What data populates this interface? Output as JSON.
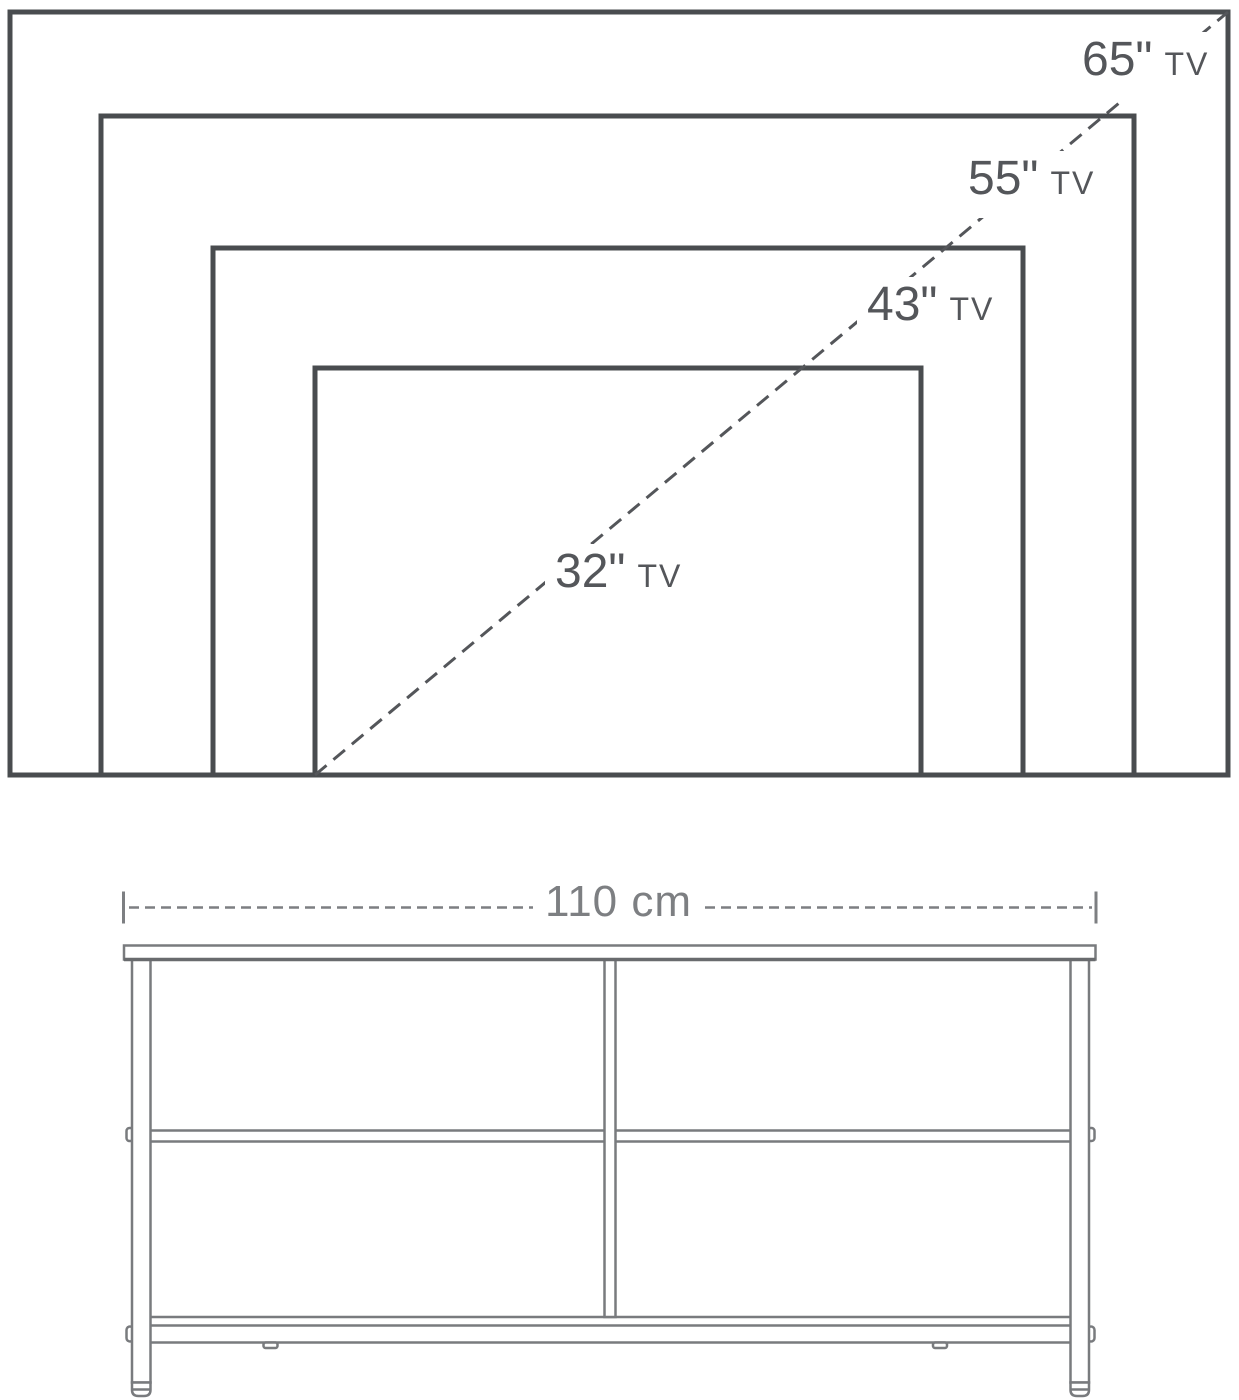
{
  "tv_size_chart": {
    "labels": [
      {
        "size": "65\"",
        "unit": "TV"
      },
      {
        "size": "55\"",
        "unit": "TV"
      },
      {
        "size": "43\"",
        "unit": "TV"
      },
      {
        "size": "32\"",
        "unit": "TV"
      }
    ],
    "line_color": "#494c4f",
    "label_color": "#54565a"
  },
  "tv_stand": {
    "width_label": "110 cm",
    "line_color": "#797b7e",
    "dimension_color": "#7d7f82"
  }
}
